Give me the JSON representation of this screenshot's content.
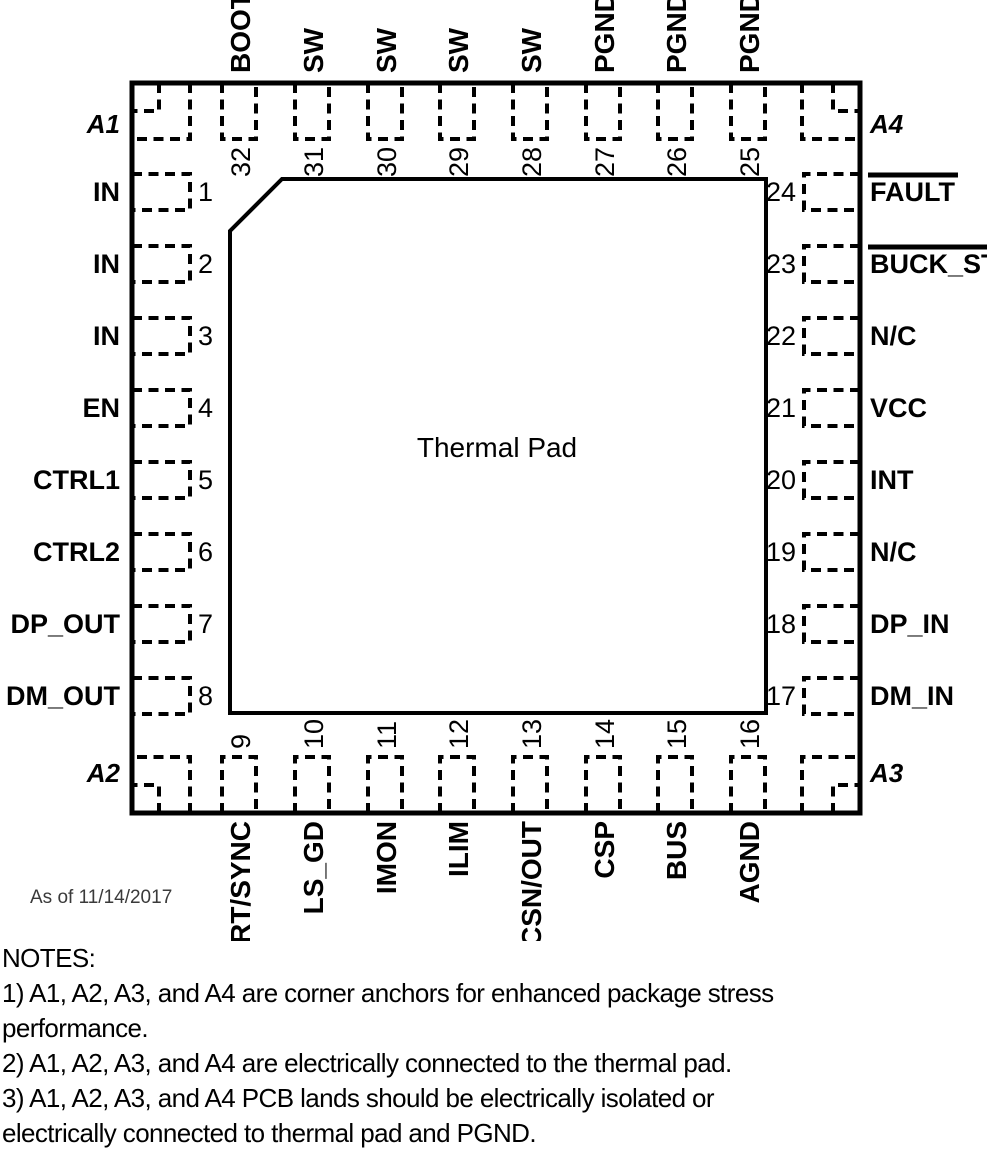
{
  "diagram": {
    "thermal_pad_label": "Thermal Pad",
    "date_note": "As of 11/14/2017",
    "corners": {
      "top_left": "A1",
      "top_right": "A4",
      "bottom_left": "A2",
      "bottom_right": "A3"
    },
    "pins": {
      "top": [
        {
          "num": "32",
          "label": "BOOT"
        },
        {
          "num": "31",
          "label": "SW"
        },
        {
          "num": "30",
          "label": "SW"
        },
        {
          "num": "29",
          "label": "SW"
        },
        {
          "num": "28",
          "label": "SW"
        },
        {
          "num": "27",
          "label": "PGND"
        },
        {
          "num": "26",
          "label": "PGND"
        },
        {
          "num": "25",
          "label": "PGND"
        }
      ],
      "left": [
        {
          "num": "1",
          "label": "IN"
        },
        {
          "num": "2",
          "label": "IN"
        },
        {
          "num": "3",
          "label": "IN"
        },
        {
          "num": "4",
          "label": "EN"
        },
        {
          "num": "5",
          "label": "CTRL1"
        },
        {
          "num": "6",
          "label": "CTRL2"
        },
        {
          "num": "7",
          "label": "DP_OUT"
        },
        {
          "num": "8",
          "label": "DM_OUT"
        }
      ],
      "right": [
        {
          "num": "24",
          "label": "FAULT",
          "overline": true
        },
        {
          "num": "23",
          "label": "BUCK_ST",
          "overline": true
        },
        {
          "num": "22",
          "label": "N/C"
        },
        {
          "num": "21",
          "label": "VCC"
        },
        {
          "num": "20",
          "label": "INT"
        },
        {
          "num": "19",
          "label": "N/C"
        },
        {
          "num": "18",
          "label": "DP_IN"
        },
        {
          "num": "17",
          "label": "DM_IN"
        }
      ],
      "bottom": [
        {
          "num": "9",
          "label": "RT/SYNC"
        },
        {
          "num": "10",
          "label": "LS_GD"
        },
        {
          "num": "11",
          "label": "IMON"
        },
        {
          "num": "12",
          "label": "ILIM"
        },
        {
          "num": "13",
          "label": "CSN/OUT"
        },
        {
          "num": "14",
          "label": "CSP"
        },
        {
          "num": "15",
          "label": "BUS"
        },
        {
          "num": "16",
          "label": "AGND"
        }
      ]
    }
  },
  "notes": {
    "lines": [
      "NOTES:",
      "1) A1, A2, A3, and A4 are corner anchors for enhanced package stress",
      "performance.",
      "2) A1, A2, A3, and A4 are electrically connected to the thermal pad.",
      "3) A1, A2, A3, and A4 PCB lands should be electrically isolated or",
      "electrically connected to thermal pad and PGND."
    ]
  }
}
